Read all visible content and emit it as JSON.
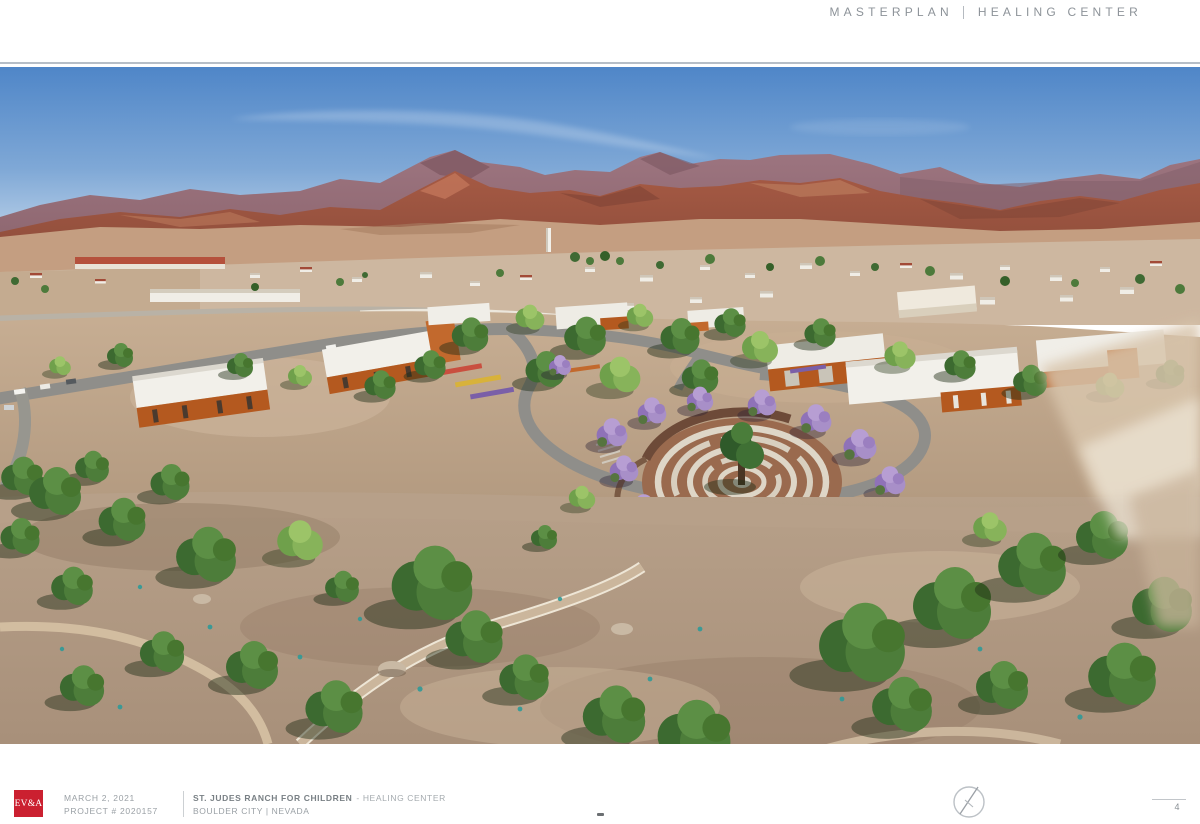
{
  "header": {
    "section": "MASTERPLAN",
    "project": "HEALING CENTER"
  },
  "title_block": {
    "logo": "EV&A",
    "date": "MARCH 2, 2021",
    "project_number": "PROJECT # 2020157",
    "client": "ST. JUDES RANCH FOR CHILDREN",
    "project_name": "- HEALING CENTER",
    "location": "BOULDER CITY | NEVADA"
  },
  "sheet": {
    "page_number": "4"
  },
  "icons": {
    "north_arrow": "north-arrow-icon"
  },
  "colors": {
    "brand_red": "#cb2030",
    "header_gray": "#8d9399",
    "text_gray": "#9aa0a5",
    "title_gray": "#798085",
    "rule_gray": "#b6bec7"
  }
}
